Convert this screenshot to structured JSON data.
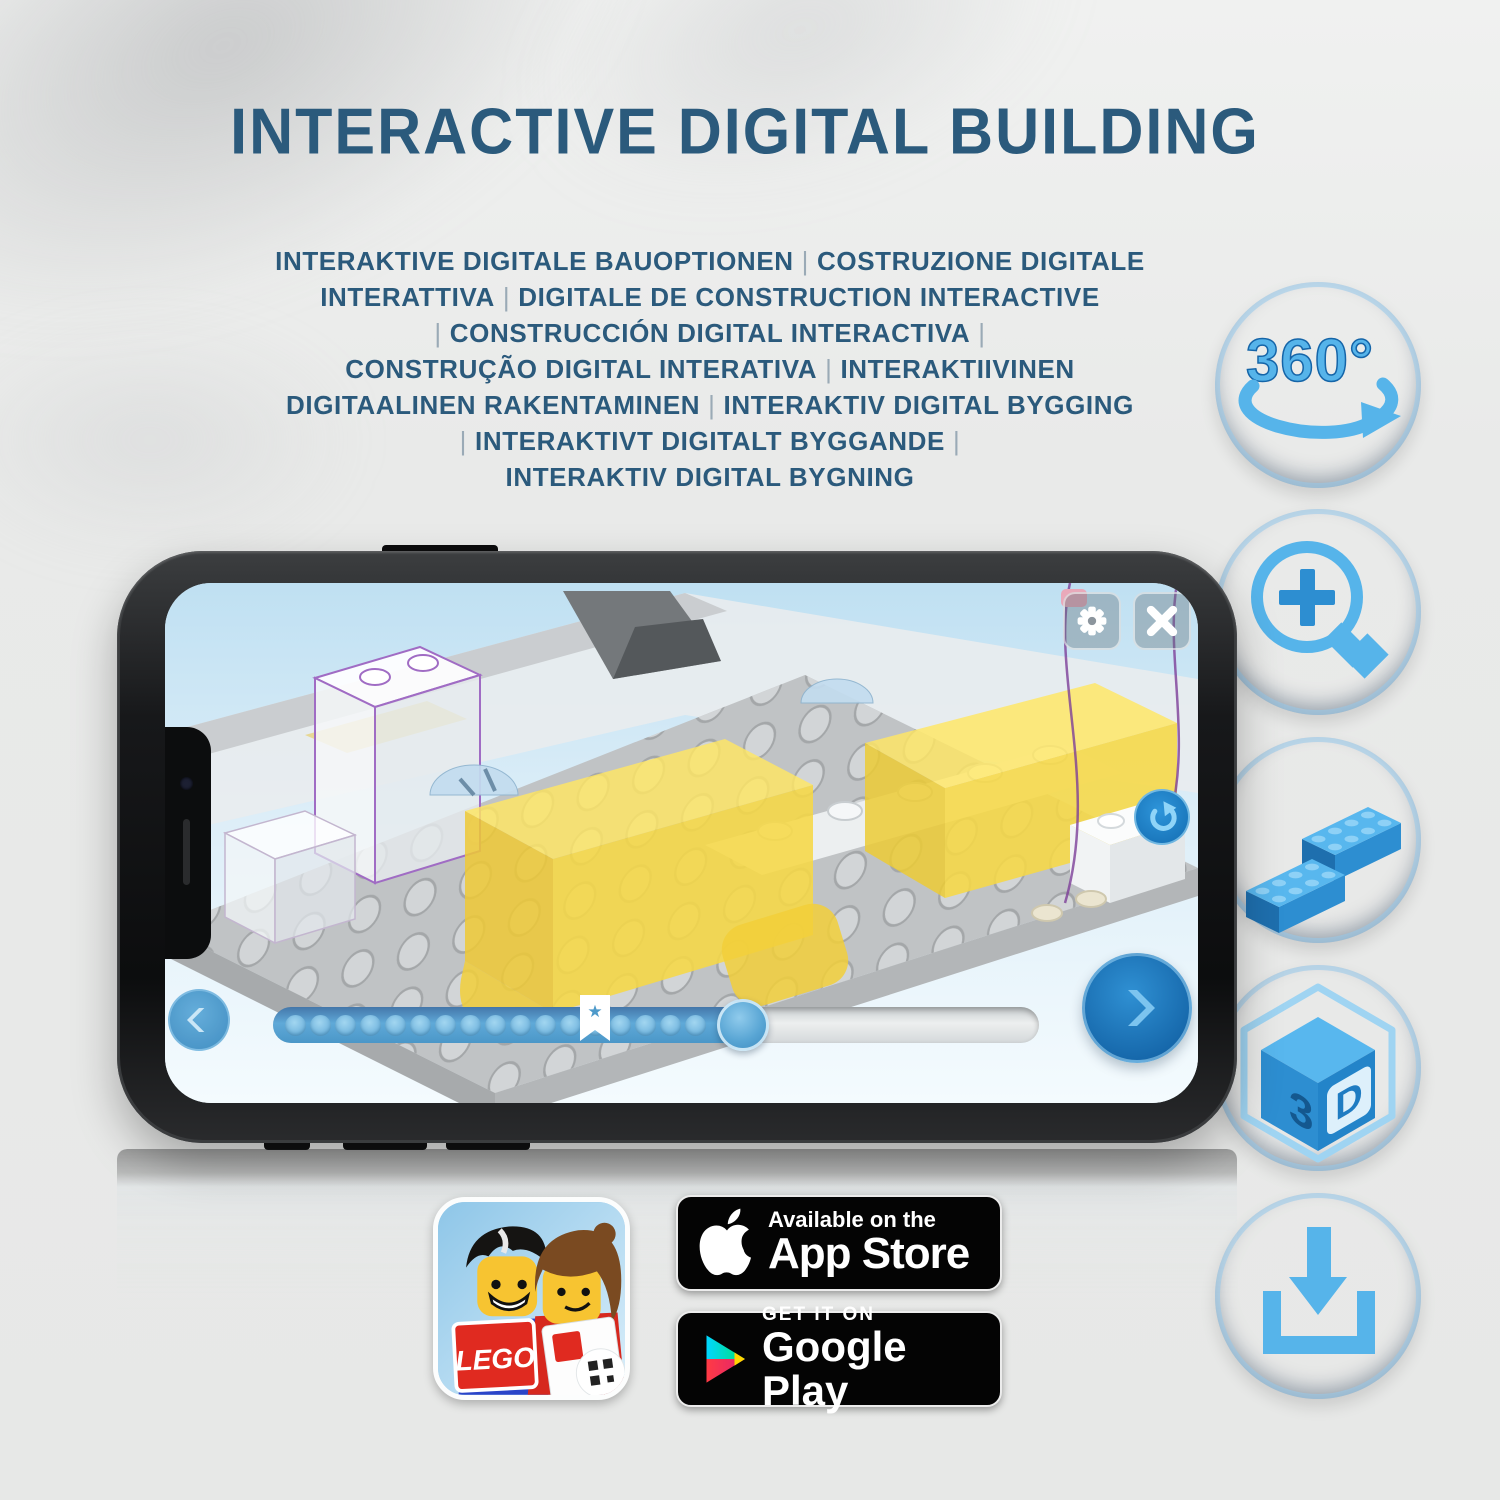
{
  "title": {
    "text": "INTERACTIVE DIGITAL BUILDING",
    "color": "#2b5a7c"
  },
  "subtitle": {
    "pipe_color": "#9aaab6",
    "lines": [
      "INTERAKTIVE DIGITALE BAUOPTIONEN | COSTRUZIONE DIGITALE",
      "INTERATTIVA | DIGITALE DE CONSTRUCTION INTERACTIVE",
      "| CONSTRUCCIÓN DIGITAL INTERACTIVA |",
      "CONSTRUÇÃO DIGITAL INTERATIVA | INTERAKTIIVINEN",
      "DIGITAALINEN RAKENTAMINEN | INTERAKTIV DIGITAL BYGGING",
      "| INTERAKTIVT DIGITALT BYGGANDE |",
      "INTERAKTIV DIGITAL BYGNING"
    ]
  },
  "features": [
    {
      "name": "rotate-360",
      "label": "360°"
    },
    {
      "name": "zoom-in"
    },
    {
      "name": "bricks"
    },
    {
      "name": "cube-3d",
      "face_left": "3",
      "face_right": "D"
    },
    {
      "name": "download"
    }
  ],
  "phone": {
    "screen_ui": {
      "slider": {
        "progress_percent": 61,
        "bookmark_percent": 42,
        "star": "★"
      }
    }
  },
  "store_row": {
    "app_icon": {
      "logo_text": "LEGO"
    },
    "app_store": {
      "tagline": "Available on the",
      "name": "App Store"
    },
    "google_play": {
      "tagline": "GET IT ON",
      "name": "Google Play"
    }
  },
  "colors": {
    "icon_circle_blue": "#0e72b7",
    "icon_glyph_blue": "#56b4ea",
    "title_blue": "#2b5a7c",
    "lego_red": "#d6251c",
    "app_accent_blue": "#2e8fd2"
  }
}
